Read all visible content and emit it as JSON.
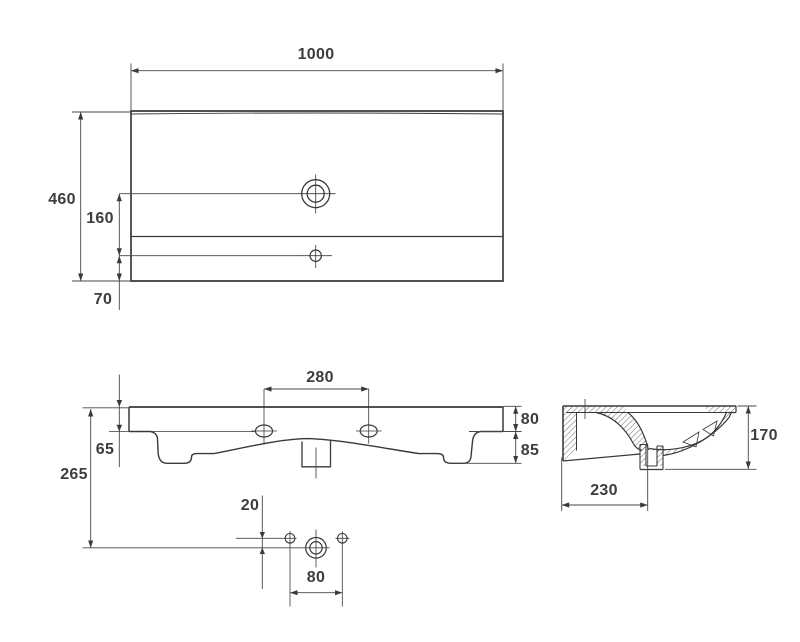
{
  "style": {
    "background": "#ffffff",
    "line_color": "#3a3a3a",
    "text_color": "#3d3d3d"
  },
  "views": {
    "top": {
      "width": "1000",
      "depth": "460",
      "faucet_to_overflow": "160",
      "overflow_to_front": "70"
    },
    "front": {
      "fixing_hole_spacing": "280",
      "height_total": "265",
      "edge_thickness": "65",
      "apron_top": "80",
      "apron_bottom": "85",
      "drain_offset": "20",
      "drain_hole_spacing": "80"
    },
    "side": {
      "height": "170",
      "drain_from_back": "230"
    }
  }
}
